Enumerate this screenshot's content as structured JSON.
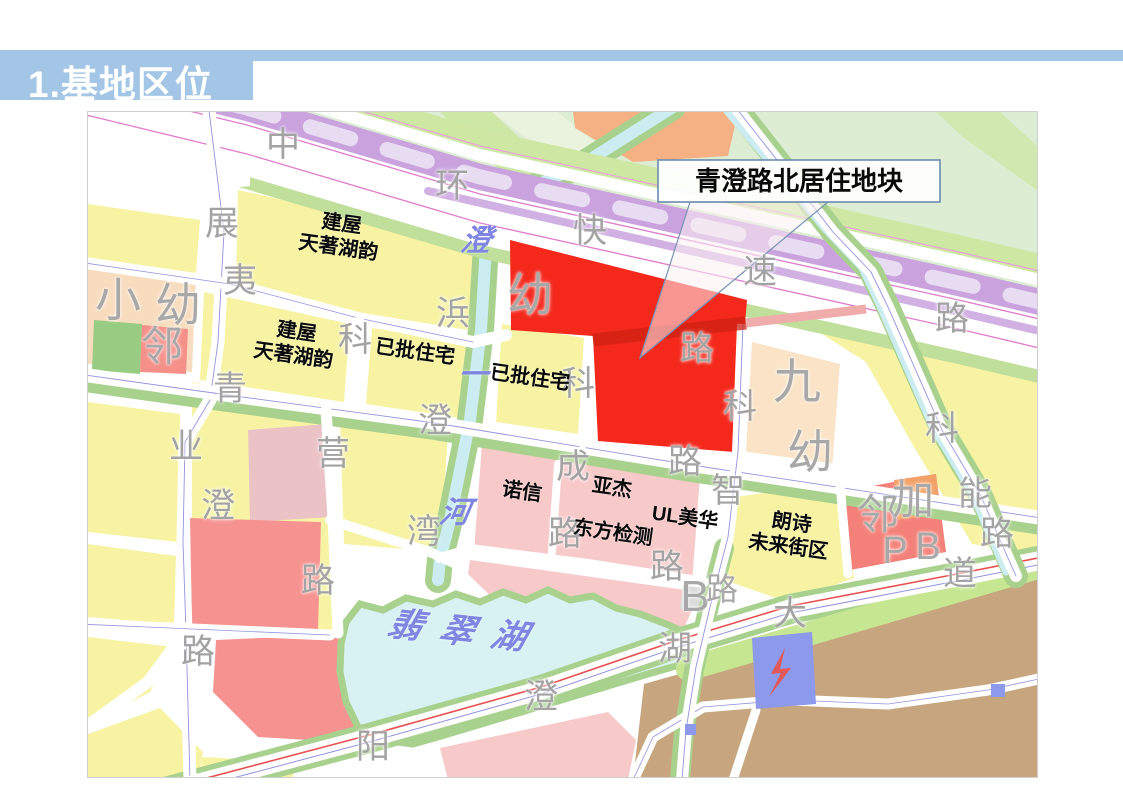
{
  "slide": {
    "title": "1.基地区位"
  },
  "callout": {
    "text": "青澄路北居住地块"
  },
  "colors": {
    "header_blue": "#A4C6E6",
    "site_red": "#F5281C",
    "parcel_yellow": "#F7F3A2",
    "parcel_pink": "#F8C9C9",
    "parcel_salmon": "#F69390",
    "parcel_brown": "#C7A67F",
    "expressway_purple": "#C9A2DE",
    "greenbelt": "#A9D18E",
    "water_cyan": "#D8F2F4",
    "road_label_gray": "#A3A3A3",
    "water_label_blue": "#7F86E2"
  },
  "map": {
    "labels": {
      "road": {
        "items": [
          {
            "t": "中",
            "x": 195,
            "y": 34
          },
          {
            "t": "环",
            "x": 364,
            "y": 75
          },
          {
            "t": "快",
            "x": 502,
            "y": 120
          },
          {
            "t": "速",
            "x": 672,
            "y": 161
          },
          {
            "t": "路",
            "x": 864,
            "y": 208
          },
          {
            "t": "展",
            "x": 134,
            "y": 113
          },
          {
            "t": "夷",
            "x": 152,
            "y": 170
          },
          {
            "t": "浜",
            "x": 365,
            "y": 203
          },
          {
            "t": "科",
            "x": 267,
            "y": 229
          },
          {
            "t": "青",
            "x": 142,
            "y": 278
          },
          {
            "t": "澄",
            "x": 347,
            "y": 310
          },
          {
            "t": "路",
            "x": 597,
            "y": 351
          },
          {
            "t": "业",
            "x": 98,
            "y": 336
          },
          {
            "t": "澄",
            "x": 130,
            "y": 395
          },
          {
            "t": "营",
            "x": 245,
            "y": 343
          },
          {
            "t": "湾",
            "x": 336,
            "y": 421
          },
          {
            "t": "路",
            "x": 230,
            "y": 470
          },
          {
            "t": "路",
            "x": 110,
            "y": 541
          },
          {
            "t": "成",
            "x": 485,
            "y": 356
          },
          {
            "t": "路",
            "x": 477,
            "y": 423
          },
          {
            "t": "智",
            "x": 640,
            "y": 380
          },
          {
            "t": "科",
            "x": 490,
            "y": 273
          },
          {
            "t": "路",
            "x": 609,
            "y": 238
          },
          {
            "t": "科",
            "x": 652,
            "y": 296
          },
          {
            "t": "路",
            "x": 579,
            "y": 456
          },
          {
            "t": "大",
            "x": 702,
            "y": 503
          },
          {
            "t": "湖",
            "x": 587,
            "y": 538
          },
          {
            "t": "澄",
            "x": 453,
            "y": 586
          },
          {
            "t": "阳",
            "x": 285,
            "y": 636
          },
          {
            "t": "道",
            "x": 872,
            "y": 463
          },
          {
            "t": "科",
            "x": 854,
            "y": 318
          },
          {
            "t": "能",
            "x": 887,
            "y": 383
          },
          {
            "t": "路",
            "x": 909,
            "y": 423
          }
        ]
      },
      "facility": {
        "items": [
          {
            "t": "小",
            "x": 30,
            "y": 188,
            "s": 46
          },
          {
            "t": "幼",
            "x": 90,
            "y": 193,
            "s": 46
          },
          {
            "t": "邻",
            "x": 74,
            "y": 235,
            "s": 42
          },
          {
            "t": "幼",
            "x": 442,
            "y": 183,
            "s": 46
          },
          {
            "t": "九",
            "x": 709,
            "y": 271,
            "s": 48
          },
          {
            "t": "幼",
            "x": 722,
            "y": 340,
            "s": 46
          },
          {
            "t": "邻",
            "x": 790,
            "y": 403,
            "s": 42
          },
          {
            "t": "加",
            "x": 825,
            "y": 388,
            "s": 42
          },
          {
            "t": "P",
            "x": 807,
            "y": 440,
            "s": 38
          },
          {
            "t": "B",
            "x": 840,
            "y": 436,
            "s": 38
          },
          {
            "t": "B",
            "x": 607,
            "y": 485,
            "s": 44
          },
          {
            "t": "路",
            "x": 634,
            "y": 478,
            "s": 32
          }
        ]
      },
      "water": {
        "skew": -10,
        "items": [
          {
            "t": "澄",
            "x": 388,
            "y": 129
          },
          {
            "t": "一",
            "x": 385,
            "y": 263
          },
          {
            "t": "河",
            "x": 367,
            "y": 401
          },
          {
            "t": "翡翠湖",
            "x": 378,
            "y": 521,
            "s": 34,
            "ls": 18,
            "r": 6
          }
        ]
      },
      "site": {
        "rotate": 8,
        "items": [
          {
            "t": "建屋\n天著湖韵",
            "x": 252,
            "y": 124
          },
          {
            "t": "建屋\n天著湖韵",
            "x": 207,
            "y": 232
          },
          {
            "t": "已批住宅",
            "x": 327,
            "y": 240
          },
          {
            "t": "已批住宅",
            "x": 442,
            "y": 266
          },
          {
            "t": "诺信",
            "x": 434,
            "y": 380
          },
          {
            "t": "亚杰",
            "x": 524,
            "y": 376
          },
          {
            "t": "UL美华",
            "x": 597,
            "y": 406
          },
          {
            "t": "东方检测",
            "x": 525,
            "y": 421
          },
          {
            "t": "朗诗\n未来街区",
            "x": 702,
            "y": 423
          }
        ]
      }
    }
  }
}
